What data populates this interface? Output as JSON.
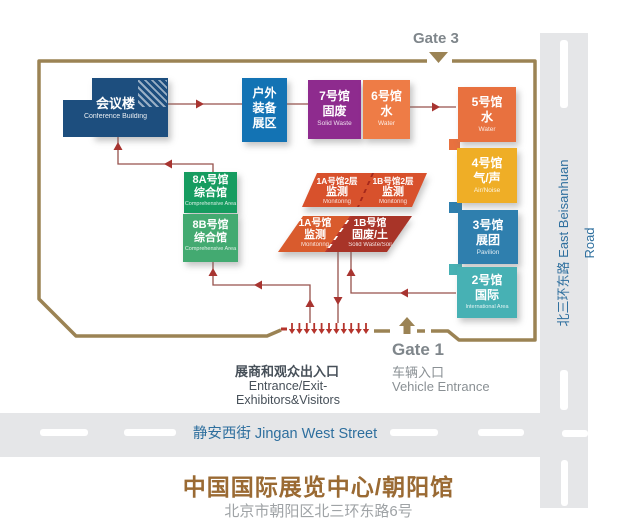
{
  "title": {
    "name": "中国国际展览中心/朝阳馆",
    "address": "北京市朝阳区北三环东路6号"
  },
  "roads": {
    "vertical_label": "北三环东路 East Beisanhuan Road",
    "horizontal_label": "静安西街 Jingan West Street"
  },
  "gates": {
    "gate3_label": "Gate 3",
    "gate1_label": "Gate 1",
    "gate1_cn": "车辆入口",
    "gate1_en": "Vehicle Entrance"
  },
  "entrance": {
    "cn": "展商和观众出入口",
    "en": "Entrance/Exit-Exhibitors&Visitors"
  },
  "buildings": {
    "conference": {
      "cn": "会议楼",
      "en": "Conference Building",
      "color": "#1d4e7e"
    },
    "outdoor": {
      "line1": "户外",
      "line2": "装备",
      "line3": "展区",
      "color": "#1373b4"
    },
    "hall7": {
      "cn": "7号馆",
      "type": "固废",
      "en": "Solid Waste",
      "color": "#8e2b8e"
    },
    "hall6": {
      "cn": "6号馆",
      "type": "水",
      "en": "Water",
      "color": "#ee7c46"
    },
    "hall5": {
      "cn": "5号馆",
      "type": "水",
      "en": "Water",
      "color": "#e8713f"
    },
    "hall4": {
      "cn": "4号馆",
      "type": "气/声",
      "en": "Air/Noise",
      "color": "#efae26"
    },
    "hall3": {
      "cn": "3号馆",
      "type": "展团",
      "en": "Pavilion",
      "color": "#2f7fae"
    },
    "hall2": {
      "cn": "2号馆",
      "type": "国际",
      "en": "International Area",
      "color": "#47b1b4"
    },
    "hall8a": {
      "cn": "8A号馆",
      "type": "综合馆",
      "en": "Comprehensive Area",
      "color": "#169c60"
    },
    "hall8b": {
      "cn": "8B号馆",
      "type": "综合馆",
      "en": "Comprehensive Area",
      "color": "#43aa71"
    },
    "hall1a2f": {
      "cn": "1A号馆2层",
      "type": "监测",
      "en": "Monitoring"
    },
    "hall1b2f": {
      "cn": "1B号馆2层",
      "type": "监测",
      "en": "Monitoring"
    },
    "hall1a": {
      "cn": "1A号馆",
      "type": "监测",
      "en": "Monitoring"
    },
    "hall1b": {
      "cn": "1B号馆",
      "type": "固废/土",
      "en": "Solid Waste/Soil"
    }
  },
  "colors": {
    "boundary": "#9b8354",
    "flow_line": "#96524c",
    "flow_head": "#a83430",
    "entrance_arrow": "#b5342c",
    "slab_top": "#d8512c",
    "slab_1a": "#d95b2d",
    "slab_1b": "#a83428",
    "road_bg": "#e5e6e8",
    "street_text": "#2e6f9e",
    "gate_text": "#7f868b",
    "title_text": "#9a6a33"
  }
}
